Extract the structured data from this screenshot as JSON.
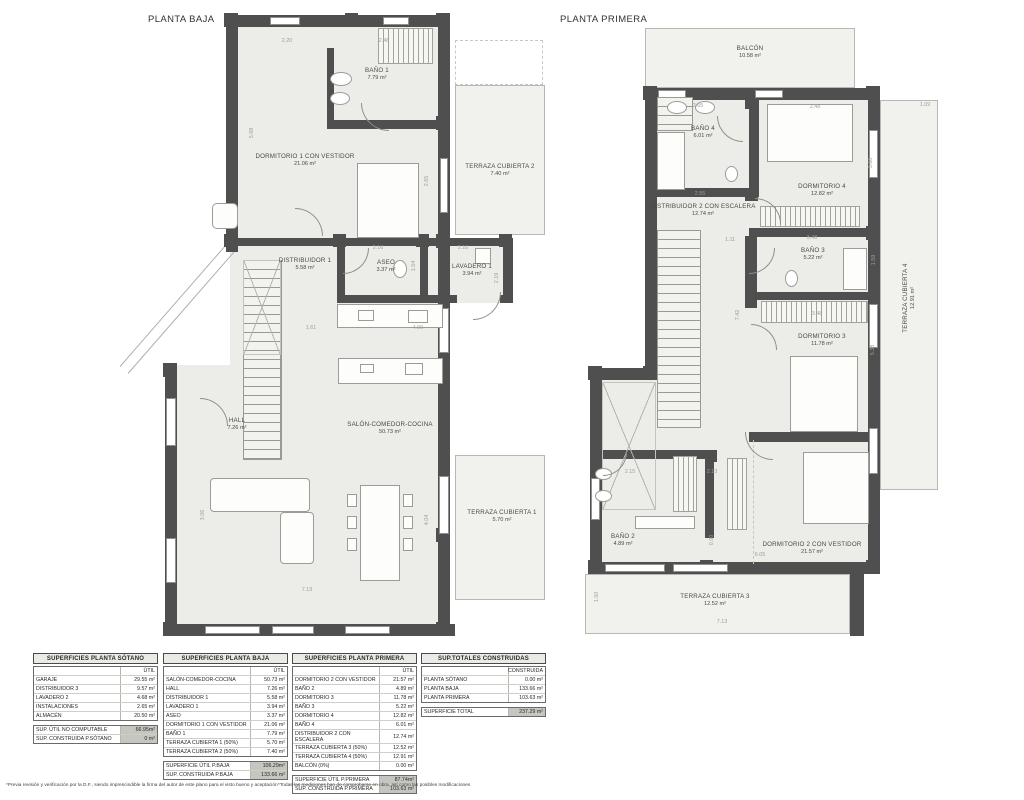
{
  "titles": {
    "left": "PLANTA BAJA",
    "right": "PLANTA PRIMERA"
  },
  "colors": {
    "wall": "#4f4f4f",
    "floor": "#ecede8",
    "terrace": "#f1f2ed",
    "total_cell": "#c6c6c0"
  },
  "plans": {
    "left": {
      "rooms": {
        "bano1": {
          "name": "BAÑO 1",
          "area": "7.79 m²"
        },
        "dorm1": {
          "name": "DORMITORIO 1 CON VESTIDOR",
          "area": "21.06 m²"
        },
        "terraza2": {
          "name": "TERRAZA CUBIERTA 2",
          "area": "7.40 m²"
        },
        "distribuidor1": {
          "name": "DISTRIBUIDOR 1",
          "area": "5.58 m²"
        },
        "aseo": {
          "name": "ASEO",
          "area": "3.37 m²"
        },
        "lavadero1": {
          "name": "LAVADERO 1",
          "area": "3.94 m²"
        },
        "hall": {
          "name": "HALL",
          "area": "7.26 m²"
        },
        "salon": {
          "name": "SALÓN-COMEDOR-COCINA",
          "area": "50.73 m²"
        },
        "terraza1": {
          "name": "TERRAZA CUBIERTA 1",
          "area": "5.70 m²"
        }
      },
      "dims": [
        {
          "t": "2.20",
          "x": 167,
          "y": 33
        },
        {
          "t": "2.46",
          "x": 264,
          "y": 33
        },
        {
          "t": "5.68",
          "x": 132,
          "y": 125,
          "v": 1
        },
        {
          "t": "2.65",
          "x": 307,
          "y": 173,
          "v": 1
        },
        {
          "t": "2.16",
          "x": 258,
          "y": 240
        },
        {
          "t": "2.16",
          "x": 343,
          "y": 240
        },
        {
          "t": "1.54",
          "x": 294,
          "y": 258,
          "v": 1
        },
        {
          "t": "2.19",
          "x": 377,
          "y": 270,
          "v": 1
        },
        {
          "t": "1.61",
          "x": 191,
          "y": 320
        },
        {
          "t": "4.90",
          "x": 298,
          "y": 320
        },
        {
          "t": "4.04",
          "x": 307,
          "y": 512,
          "v": 1
        },
        {
          "t": "3.06",
          "x": 83,
          "y": 507,
          "v": 1
        },
        {
          "t": "7.13",
          "x": 187,
          "y": 582
        }
      ]
    },
    "right": {
      "rooms": {
        "balcon": {
          "name": "BALCÓN",
          "area": "10.58 m²"
        },
        "bano4": {
          "name": "BAÑO 4",
          "area": "6.01 m²"
        },
        "dorm4": {
          "name": "DORMITORIO 4",
          "area": "12.82 m²"
        },
        "distribuidor2": {
          "name": "DISTRIBUIDOR 2 CON ESCALERA",
          "area": "12.74 m²"
        },
        "bano3": {
          "name": "BAÑO 3",
          "area": "5.22 m²"
        },
        "dorm3": {
          "name": "DORMITORIO 3",
          "area": "11.78 m²"
        },
        "bano2": {
          "name": "BAÑO 2",
          "area": "4.89 m²"
        },
        "dorm2": {
          "name": "DORMITORIO 2 CON VESTIDOR",
          "area": "21.57 m²"
        },
        "terraza3": {
          "name": "TERRAZA CUBIERTA 3",
          "area": "12.52 m²"
        },
        "terraza4": {
          "name": "TERRAZA CUBIERTA 4",
          "area": "12.91 m²"
        }
      },
      "dims": [
        {
          "t": "2.65",
          "x": 143,
          "y": 98
        },
        {
          "t": "2.48",
          "x": 260,
          "y": 99
        },
        {
          "t": "1.09",
          "x": 370,
          "y": 97
        },
        {
          "t": "3.68",
          "x": 316,
          "y": 155,
          "v": 1
        },
        {
          "t": "2.55",
          "x": 145,
          "y": 186
        },
        {
          "t": "1.11",
          "x": 175,
          "y": 232
        },
        {
          "t": "3.48",
          "x": 257,
          "y": 230
        },
        {
          "t": "1.59",
          "x": 319,
          "y": 252,
          "v": 1
        },
        {
          "t": "7.42",
          "x": 183,
          "y": 307,
          "v": 1
        },
        {
          "t": "3.48",
          "x": 262,
          "y": 306
        },
        {
          "t": "5.38",
          "x": 318,
          "y": 342,
          "v": 1
        },
        {
          "t": "2.15",
          "x": 75,
          "y": 464
        },
        {
          "t": "2.13",
          "x": 157,
          "y": 464
        },
        {
          "t": "0.90",
          "x": 157,
          "y": 532,
          "v": 1
        },
        {
          "t": "6.05",
          "x": 205,
          "y": 547
        },
        {
          "t": "1.50",
          "x": 42,
          "y": 589,
          "v": 1
        },
        {
          "t": "7.13",
          "x": 167,
          "y": 614
        }
      ]
    }
  },
  "tables": [
    {
      "title": "SUPERFICIES PLANTA SÓTANO",
      "col": "ÚTIL",
      "rows": [
        [
          "GARAJE",
          "29.55 m²"
        ],
        [
          "DISTRIBUIDOR 3",
          "9.57 m²"
        ],
        [
          "LAVADERO 2",
          "4.68 m²"
        ],
        [
          "INSTALACIONES",
          "2.65 m²"
        ],
        [
          "ALMACÉN",
          "20.50 m²"
        ]
      ],
      "totals": [
        [
          "SUP. ÚTIL NO COMPUTABLE",
          "66.95m²"
        ],
        [
          "SUP. CONSTRUIDA P.SÓTANO",
          "0 m²"
        ]
      ]
    },
    {
      "title": "SUPERFICIES PLANTA BAJA",
      "col": "ÚTIL",
      "rows": [
        [
          "SALÓN-COMEDOR-COCINA",
          "50.73 m²"
        ],
        [
          "HALL",
          "7.26 m²"
        ],
        [
          "DISTRIBUIDOR 1",
          "5.58 m²"
        ],
        [
          "LAVADERO 1",
          "3.94 m²"
        ],
        [
          "ASEO",
          "3.37 m²"
        ],
        [
          "DORMITORIO 1 CON VESTIDOR",
          "21.06 m²"
        ],
        [
          "BAÑO 1",
          "7.79 m²"
        ],
        [
          "TERRAZA CUBIERTA 1 (50%)",
          "5.70 m²"
        ],
        [
          "TERRAZA CUBIERTA 2 (50%)",
          "7.40 m²"
        ]
      ],
      "totals": [
        [
          "SUPERFICIE ÚTIL P.BAJA",
          "106.29m²"
        ],
        [
          "SUP. CONSTRUIDA P.BAJA",
          "133.66 m²"
        ]
      ]
    },
    {
      "title": "SUPERFICIES PLANTA PRIMERA",
      "col": "ÚTIL",
      "rows": [
        [
          "DORMITORIO 2 CON VESTIDOR",
          "21.57 m²"
        ],
        [
          "BAÑO 2",
          "4.89 m²"
        ],
        [
          "DORMITORIO 3",
          "11.78 m²"
        ],
        [
          "BAÑO 3",
          "5.22 m²"
        ],
        [
          "DORMITORIO 4",
          "12.82 m²"
        ],
        [
          "BAÑO 4",
          "6.01 m²"
        ],
        [
          "DISTRIBUIDOR 2 CON ESCALERA",
          "12.74 m²"
        ],
        [
          "TERRAZA CUBIERTA 3 (50%)",
          "12.52 m²"
        ],
        [
          "TERRAZA CUBIERTA 4 (50%)",
          "12.91 m²"
        ],
        [
          "BALCÓN (0%)",
          "0.00 m²"
        ]
      ],
      "totals": [
        [
          "SUPERFICIE ÚTIL P.PRIMERA",
          "87.74m²"
        ],
        [
          "SUP. CONSTRUIDA P.PRIMERA",
          "103.63 m²"
        ]
      ]
    },
    {
      "title": "SUP.TOTALES CONSTRUIDAS",
      "col": "CONSTRUIDA",
      "rows": [
        [
          "PLANTA SÓTANO",
          "0.00 m²"
        ],
        [
          "PLANTA BAJA",
          "133.66 m²"
        ],
        [
          "PLANTA PRIMERA",
          "103.63 m²"
        ]
      ],
      "totals": [
        [
          "SUPERFICIE TOTAL",
          "237.29 m²"
        ]
      ]
    }
  ],
  "footnotes": {
    "left": "*Previa revisión y verificación por la D.F., siendo imprescindible la firma del autor de este plano para el visto bueno y aceptación",
    "right": "*Todas las mediciones han de comprobarse en obra, así como las posibles modificaciones"
  }
}
